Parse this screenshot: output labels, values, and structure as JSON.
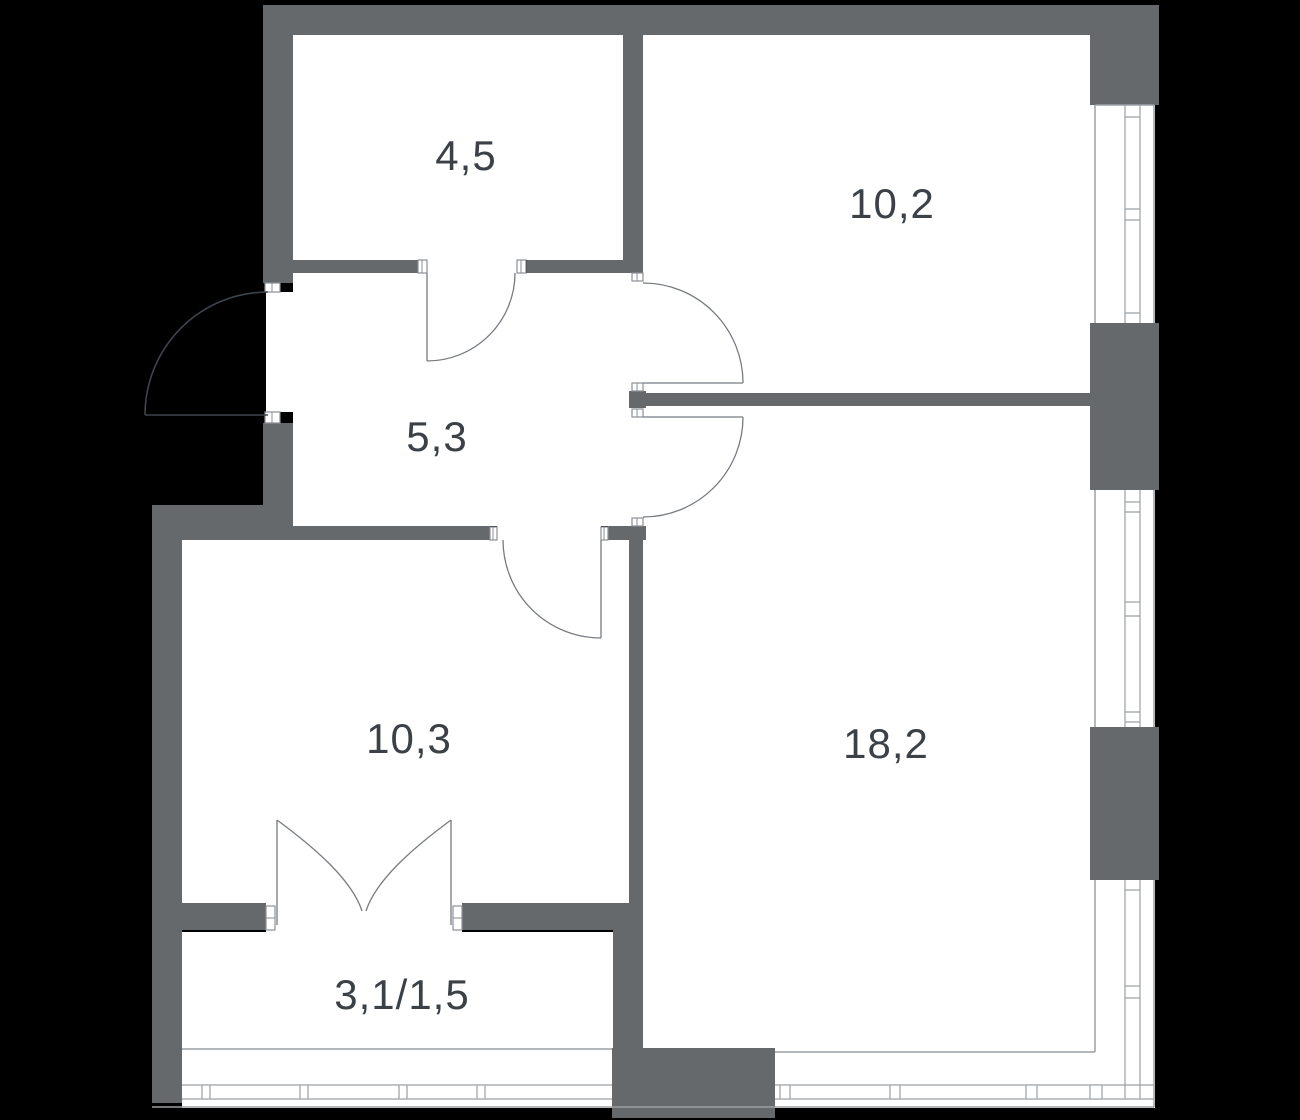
{
  "plan": {
    "type": "apartment-floor-plan",
    "rooms": [
      {
        "id": "storage",
        "label": "4,5"
      },
      {
        "id": "bedroom",
        "label": "10,2"
      },
      {
        "id": "hallway",
        "label": "5,3"
      },
      {
        "id": "kitchen",
        "label": "10,3"
      },
      {
        "id": "living-room",
        "label": "18,2"
      },
      {
        "id": "balcony",
        "label": "3,1/1,5"
      }
    ],
    "features": [
      "entrance-door-arc",
      "interior-door-arcs",
      "french-balcony-doors",
      "window-glazing-right",
      "window-glazing-bottom"
    ],
    "palette": {
      "background": "#000000",
      "wall": "#65696c",
      "floor": "#ffffff",
      "window_line": "#9ba0a4",
      "jamb_line": "#8b9097",
      "door_arc": "#767b80",
      "entrance_arc": "#3d4450",
      "label_text": "#3b4146"
    }
  }
}
